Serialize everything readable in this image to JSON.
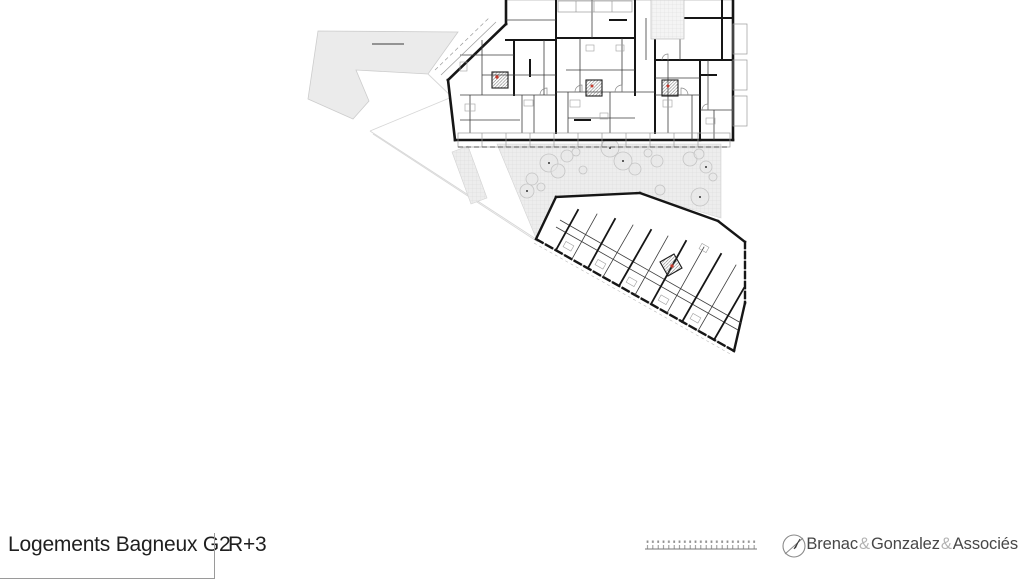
{
  "footer": {
    "project_title": "Logements Bagneux G2",
    "level": "R+3",
    "firm": {
      "name1": "Brenac",
      "sep1": "&",
      "name2": "Gonzalez",
      "sep2": "&",
      "name3": "Associés"
    }
  },
  "plan": {
    "kind": "architectural floor plan",
    "wall_color": "#161616",
    "site_fill": "#ebebeb",
    "courtyard_fill": "#ededed",
    "accent_red": "#c43b2e"
  },
  "scalebar": {
    "ticks": 21
  },
  "compass": {
    "type": "north-arrow"
  }
}
